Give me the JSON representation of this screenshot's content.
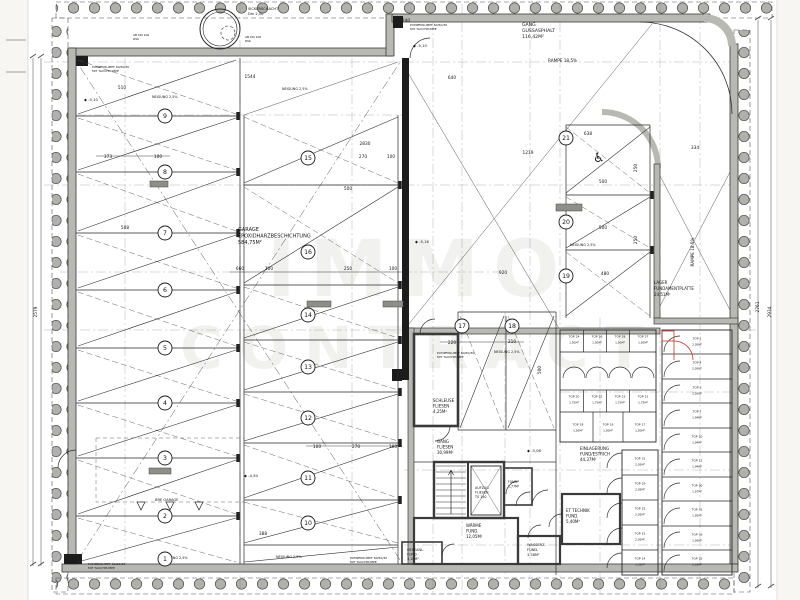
{
  "watermark": {
    "line1": "IMMO",
    "line2": "CONTRACT"
  },
  "colors": {
    "red": "#c0392b",
    "wall": "#b9b9b4",
    "line": "#2a2a2a",
    "insulation": "#b0b0ac"
  },
  "labels": [
    {
      "id": "sickerschacht-label",
      "ls": [
        "SICKERSCHACHT",
        "Dm 2,00"
      ],
      "x": 248,
      "y": 10,
      "s": 3.6,
      "lh": 5
    },
    {
      "id": "gang-gussasphalt-label",
      "ls": [
        "GANG",
        "GUSSASPHALT",
        "116,42M²"
      ],
      "x": 522,
      "y": 26,
      "s": 4.6,
      "lh": 6
    },
    {
      "id": "rampe-top-label",
      "ls": [
        "RAMPE 18,5%"
      ],
      "x": 548,
      "y": 62,
      "s": 4.2
    },
    {
      "id": "garage-label",
      "ls": [
        "GARAGE",
        "EPOXIDHARZBESCHICHTUNG",
        "584,75M²"
      ],
      "x": 238,
      "y": 231,
      "s": 5,
      "lh": 6.5
    },
    {
      "id": "rampe-side-label",
      "ls": [
        "RAMPE 18,5%"
      ],
      "x": 694,
      "y": 252,
      "s": 4.2,
      "r": -90,
      "a": "m"
    },
    {
      "id": "lager-fundamentplatte-label",
      "ls": [
        "LAGER",
        "FUNDAMENTPLATTE",
        "24,51M²"
      ],
      "x": 654,
      "y": 284,
      "s": 4,
      "lh": 6,
      "c": "red"
    },
    {
      "id": "schleuse-label",
      "ls": [
        "SCHLEUSE",
        "FLIESEN",
        "4,25M²"
      ],
      "x": 433,
      "y": 402,
      "s": 4,
      "lh": 5.5
    },
    {
      "id": "gang-fliesen-label",
      "ls": [
        "GANG",
        "FLIESEN",
        "30,99M²"
      ],
      "x": 437,
      "y": 443,
      "s": 4,
      "lh": 5.5
    },
    {
      "id": "aufzug-label",
      "ls": [
        "AUFZUG",
        "FLIESEN",
        "TS 140"
      ],
      "x": 475,
      "y": 489,
      "s": 3.3,
      "lh": 4.5
    },
    {
      "id": "waerme-label",
      "ls": [
        "WÄRME",
        "FUND.",
        "12,05M²"
      ],
      "x": 466,
      "y": 527,
      "s": 4,
      "lh": 5.5
    },
    {
      "id": "hebeanl-label",
      "ls": [
        "HEBEANL.",
        "FUND.",
        "3,18M²"
      ],
      "x": 407,
      "y": 551,
      "s": 3.4,
      "lh": 4.6
    },
    {
      "id": "wasserz-label",
      "ls": [
        "WASSERZ.",
        "FUND.",
        "3,58M²"
      ],
      "x": 527,
      "y": 546,
      "s": 3.6,
      "lh": 5
    },
    {
      "id": "et-technik-label",
      "ls": [
        "ET TECHNIK",
        "FUND.",
        "5,40M²"
      ],
      "x": 566,
      "y": 512,
      "s": 4,
      "lh": 5.5
    },
    {
      "id": "einlagerung-label",
      "ls": [
        "EINLAGERUNG",
        "FUND/ESTRICH",
        "44,37M²"
      ],
      "x": 580,
      "y": 450,
      "s": 4,
      "lh": 5.5
    },
    {
      "id": "fund-kleinraum-label",
      "ls": [
        "FUND.",
        "1,77M²"
      ],
      "x": 508,
      "y": 483,
      "s": 3.2,
      "lh": 4.4
    },
    {
      "id": "bre-garage-label",
      "ls": [
        "BRE GARAGE"
      ],
      "x": 155,
      "y": 501,
      "s": 3.6
    },
    {
      "id": "neigung-1",
      "ls": [
        "NEIGUNG 2,5%"
      ],
      "x": 152,
      "y": 98,
      "s": 3.4
    },
    {
      "id": "neigung-2",
      "ls": [
        "NEIGUNG 2,5%"
      ],
      "x": 282,
      "y": 90,
      "s": 3.4
    },
    {
      "id": "neigung-3",
      "ls": [
        "NEIGUNG 2,5%"
      ],
      "x": 494,
      "y": 353,
      "s": 3.4
    },
    {
      "id": "neigung-4",
      "ls": [
        "NEIGUNG 2,5%"
      ],
      "x": 570,
      "y": 246,
      "s": 3.4
    },
    {
      "id": "neigung-5",
      "ls": [
        "NEIGUNG 2,5%"
      ],
      "x": 162,
      "y": 559,
      "s": 3.4
    },
    {
      "id": "neigung-6",
      "ls": [
        "NEIGUNG 2,5%"
      ],
      "x": 276,
      "y": 558,
      "s": 3.4
    },
    {
      "id": "pumpensumpf-1",
      "ls": [
        "PUMPENSUMPF 60/60/30",
        "MIT TAUCHPUMPE"
      ],
      "x": 92,
      "y": 68,
      "s": 3,
      "lh": 4
    },
    {
      "id": "pumpensumpf-2",
      "ls": [
        "PUMPENSUMPF 60/60/30",
        "MIT TAUCHPUMPE"
      ],
      "x": 410,
      "y": 26,
      "s": 3,
      "lh": 4
    },
    {
      "id": "pumpensumpf-3",
      "ls": [
        "PUMPENSUMPF 60/60/30",
        "MIT TAUCHPUMPE"
      ],
      "x": 437,
      "y": 354,
      "s": 3,
      "lh": 4
    },
    {
      "id": "pumpensumpf-4",
      "ls": [
        "PUMPENSUMPF 60/60/30",
        "MIT TAUCHPUMPE"
      ],
      "x": 350,
      "y": 559,
      "s": 3,
      "lh": 4
    },
    {
      "id": "pumpensumpf-5",
      "ls": [
        "PUMPENSUMPF 60/60/30",
        "MIT TAUCHPUMPE"
      ],
      "x": 88,
      "y": 565,
      "s": 3,
      "lh": 4
    },
    {
      "id": "drain-note-1",
      "ls": [
        "AB DN 100",
        "RSK"
      ],
      "x": 133,
      "y": 36,
      "s": 3,
      "lh": 4
    },
    {
      "id": "drain-note-2",
      "ls": [
        "AB DN 100",
        "RSK"
      ],
      "x": 245,
      "y": 38,
      "s": 3,
      "lh": 4
    },
    {
      "id": "wheelchair-icon",
      "ls": [
        "♿"
      ],
      "x": 593,
      "y": 162,
      "s": 13
    }
  ],
  "dims": [
    {
      "t": "2579",
      "x": 37,
      "y": 312,
      "r": -90
    },
    {
      "t": "2761",
      "x": 759,
      "y": 307,
      "r": -90
    },
    {
      "t": "2934",
      "x": 771,
      "y": 312,
      "r": -90
    },
    {
      "t": "1544",
      "x": 250,
      "y": 78
    },
    {
      "t": "510",
      "x": 122,
      "y": 89
    },
    {
      "t": "373",
      "x": 108,
      "y": 158
    },
    {
      "t": "100",
      "x": 158,
      "y": 158
    },
    {
      "t": "508",
      "x": 125,
      "y": 229
    },
    {
      "t": "660",
      "x": 240,
      "y": 270
    },
    {
      "t": "100",
      "x": 269,
      "y": 270
    },
    {
      "t": "250",
      "x": 348,
      "y": 270
    },
    {
      "t": "100",
      "x": 393,
      "y": 270
    },
    {
      "t": "2830",
      "x": 365,
      "y": 145
    },
    {
      "t": "270",
      "x": 363,
      "y": 158
    },
    {
      "t": "100",
      "x": 391,
      "y": 158
    },
    {
      "t": "500",
      "x": 348,
      "y": 190
    },
    {
      "t": "240",
      "x": 406,
      "y": 22
    },
    {
      "t": "640",
      "x": 452,
      "y": 79
    },
    {
      "t": "1219",
      "x": 528,
      "y": 154
    },
    {
      "t": "334",
      "x": 695,
      "y": 149
    },
    {
      "t": "638",
      "x": 588,
      "y": 135
    },
    {
      "t": "500",
      "x": 603,
      "y": 183
    },
    {
      "t": "500",
      "x": 603,
      "y": 229
    },
    {
      "t": "480",
      "x": 605,
      "y": 275
    },
    {
      "t": "250",
      "x": 637,
      "y": 168,
      "r": -90
    },
    {
      "t": "250",
      "x": 637,
      "y": 240,
      "r": -90
    },
    {
      "t": "920",
      "x": 503,
      "y": 274
    },
    {
      "t": "220",
      "x": 452,
      "y": 344
    },
    {
      "t": "210",
      "x": 512,
      "y": 343
    },
    {
      "t": "500",
      "x": 541,
      "y": 370,
      "r": -90
    },
    {
      "t": "100",
      "x": 317,
      "y": 448
    },
    {
      "t": "270",
      "x": 356,
      "y": 448
    },
    {
      "t": "100",
      "x": 393,
      "y": 448
    },
    {
      "t": "388",
      "x": 263,
      "y": 535
    }
  ],
  "levels": [
    {
      "t": "-5,10",
      "x": 84,
      "y": 101
    },
    {
      "t": "-5,10",
      "x": 413,
      "y": 47
    },
    {
      "t": "-5,16",
      "x": 415,
      "y": 243
    },
    {
      "t": "-5,06",
      "x": 527,
      "y": 452
    },
    {
      "t": "-4,94",
      "x": 244,
      "y": 477
    }
  ],
  "parking_spots": [
    {
      "n": "1",
      "x": 165,
      "y": 559
    },
    {
      "n": "2",
      "x": 165,
      "y": 516
    },
    {
      "n": "3",
      "x": 165,
      "y": 458
    },
    {
      "n": "4",
      "x": 165,
      "y": 403
    },
    {
      "n": "5",
      "x": 165,
      "y": 348
    },
    {
      "n": "6",
      "x": 165,
      "y": 290
    },
    {
      "n": "7",
      "x": 165,
      "y": 233
    },
    {
      "n": "8",
      "x": 165,
      "y": 172
    },
    {
      "n": "9",
      "x": 165,
      "y": 116
    },
    {
      "n": "10",
      "x": 308,
      "y": 523
    },
    {
      "n": "11",
      "x": 308,
      "y": 478
    },
    {
      "n": "12",
      "x": 308,
      "y": 418
    },
    {
      "n": "13",
      "x": 308,
      "y": 367
    },
    {
      "n": "14",
      "x": 308,
      "y": 315
    },
    {
      "n": "15",
      "x": 308,
      "y": 158
    },
    {
      "n": "16",
      "x": 308,
      "y": 252
    },
    {
      "n": "17",
      "x": 462,
      "y": 326
    },
    {
      "n": "18",
      "x": 512,
      "y": 326
    },
    {
      "n": "19",
      "x": 566,
      "y": 276
    },
    {
      "n": "20",
      "x": 566,
      "y": 222
    },
    {
      "n": "21",
      "x": 566,
      "y": 138
    }
  ],
  "storage_cells": [
    {
      "a": "TOP 24",
      "b": "1,50M²",
      "x": 574,
      "y": 340
    },
    {
      "a": "TOP 26",
      "b": "1,50M²",
      "x": 597,
      "y": 340
    },
    {
      "a": "TOP 28",
      "b": "1,50M²",
      "x": 620,
      "y": 340
    },
    {
      "a": "TOP 27",
      "b": "1,50M²",
      "x": 643,
      "y": 340
    },
    {
      "a": "TOP 20",
      "b": "1,75M²",
      "x": 574,
      "y": 400
    },
    {
      "a": "TOP 22",
      "b": "1,75M²",
      "x": 597,
      "y": 400
    },
    {
      "a": "TOP 23",
      "b": "1,75M²",
      "x": 620,
      "y": 400
    },
    {
      "a": "TOP 21",
      "b": "1,75M²",
      "x": 643,
      "y": 400
    },
    {
      "a": "TOP 18",
      "b": "1,50M²",
      "x": 578,
      "y": 428
    },
    {
      "a": "TOP 19",
      "b": "1,50M²",
      "x": 608,
      "y": 428
    },
    {
      "a": "TOP 17",
      "b": "1,50M²",
      "x": 640,
      "y": 428
    },
    {
      "a": "TOP 31",
      "b": "2,05M²",
      "x": 640,
      "y": 462
    },
    {
      "a": "TOP 29",
      "b": "2,05M²",
      "x": 640,
      "y": 487
    },
    {
      "a": "TOP 25",
      "b": "2,05M²",
      "x": 640,
      "y": 512
    },
    {
      "a": "TOP 15",
      "b": "2,05M²",
      "x": 640,
      "y": 537
    },
    {
      "a": "TOP 14",
      "b": "1,35M²",
      "x": 640,
      "y": 562
    },
    {
      "a": "TOP 2",
      "b": "2,05M²",
      "x": 697,
      "y": 342
    },
    {
      "a": "TOP 4",
      "b": "2,05M²",
      "x": 697,
      "y": 366
    },
    {
      "a": "TOP 3",
      "b": "2,05M²",
      "x": 697,
      "y": 391
    },
    {
      "a": "TOP 7",
      "b": "1,94M²",
      "x": 697,
      "y": 415
    },
    {
      "a": "TOP 10",
      "b": "1,94M²",
      "x": 697,
      "y": 440
    },
    {
      "a": "TOP 12",
      "b": "1,94M²",
      "x": 697,
      "y": 464
    },
    {
      "a": "TOP 30",
      "b": "1,97M²",
      "x": 697,
      "y": 489
    },
    {
      "a": "TOP 35",
      "b": "1,95M²",
      "x": 697,
      "y": 513
    },
    {
      "a": "TOP 36",
      "b": "1,95M²",
      "x": 697,
      "y": 538
    },
    {
      "a": "TOP 32",
      "b": "2,52M²",
      "x": 697,
      "y": 562
    }
  ]
}
